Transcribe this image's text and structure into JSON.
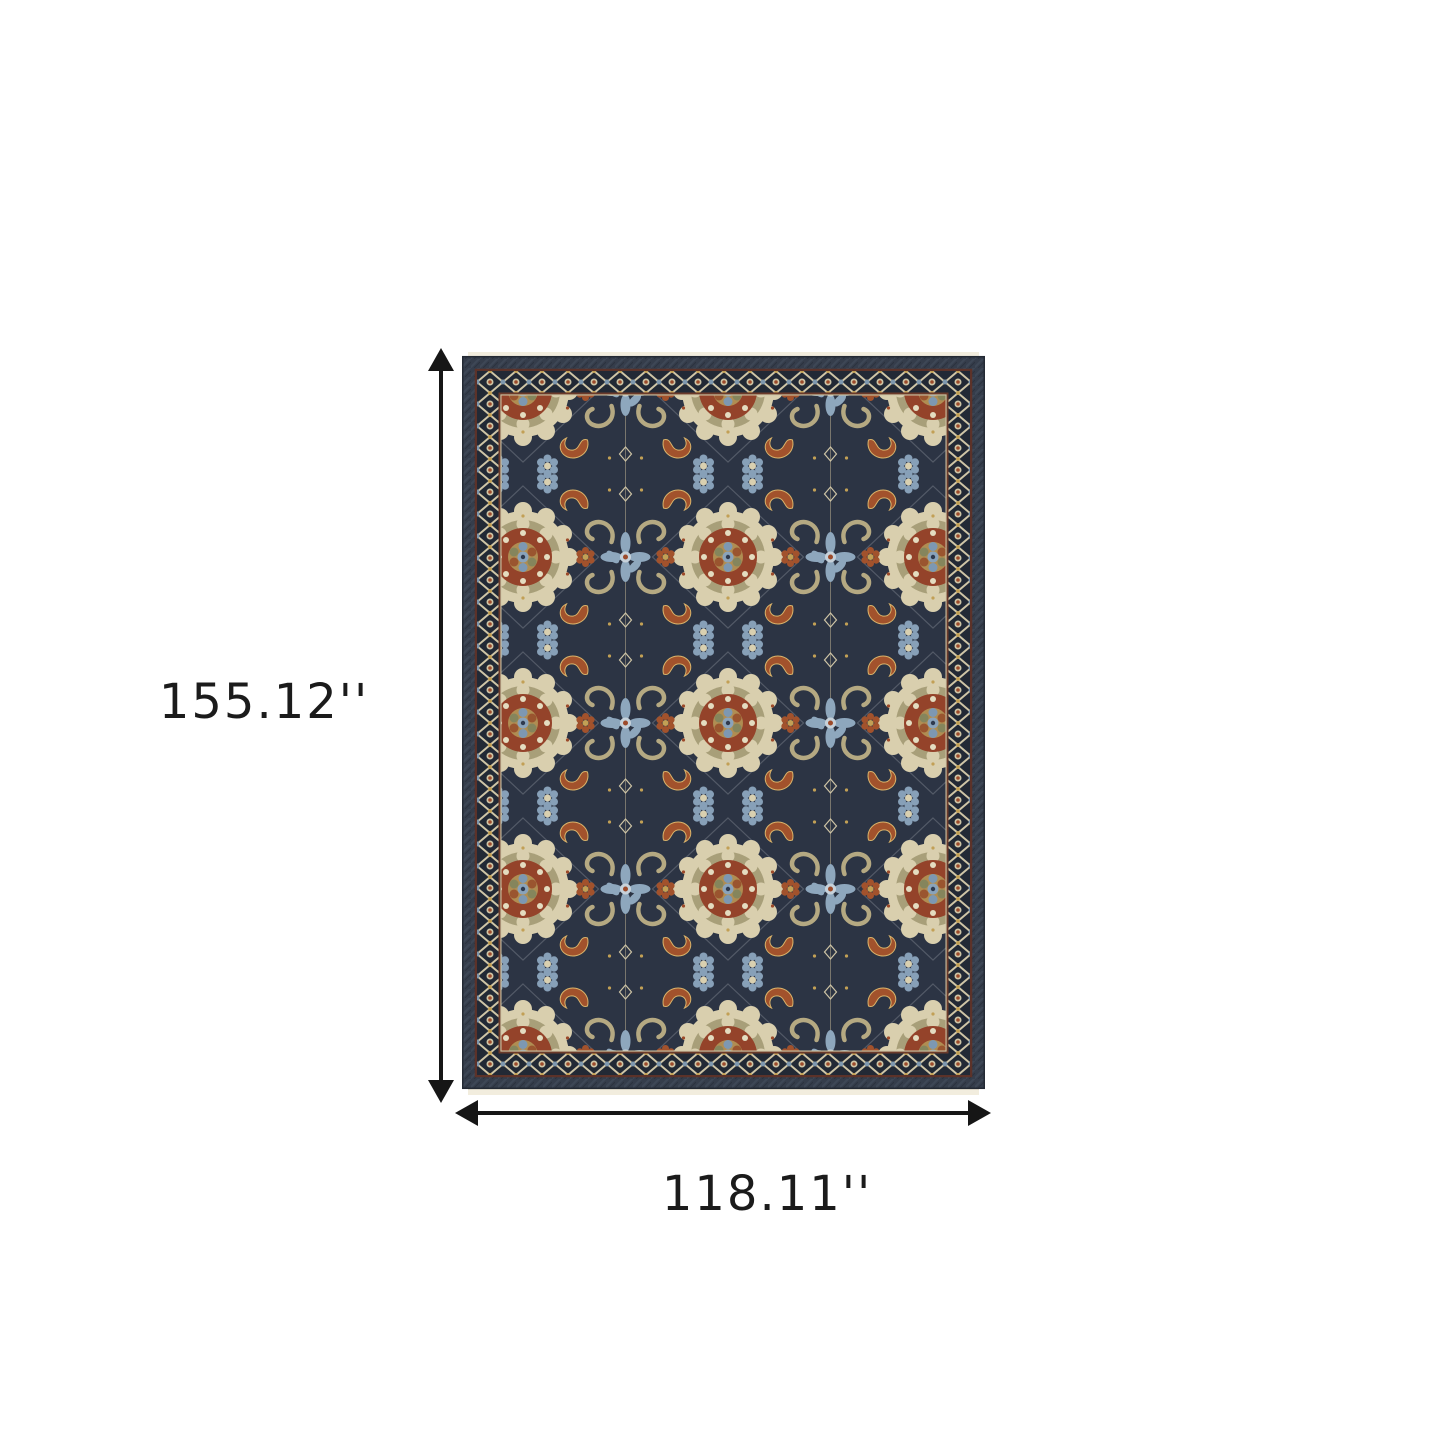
{
  "page": {
    "background_color": "#ffffff",
    "description": "Product dimension diagram of an area rug on a white background"
  },
  "rug": {
    "description": "Blue rust gold and cream traditional oriental floral medallion area rug with fringe",
    "palette": {
      "field_navy": "#2c3444",
      "band_navy": "#353d4b",
      "cream": "#d9cfae",
      "bright_cream": "#ece4c8",
      "tan": "#b3a57e",
      "sage": "#8f9070",
      "rust": "#9c4a2a",
      "steel_blue": "#8ba3ba",
      "gold": "#c2a055",
      "maroon_guard": "#5c3229",
      "fringe": "#f2edde"
    }
  },
  "dimensions": {
    "height": {
      "label": "155.12''"
    },
    "width": {
      "label": "118.11''"
    },
    "arrow_color": "#161616"
  }
}
